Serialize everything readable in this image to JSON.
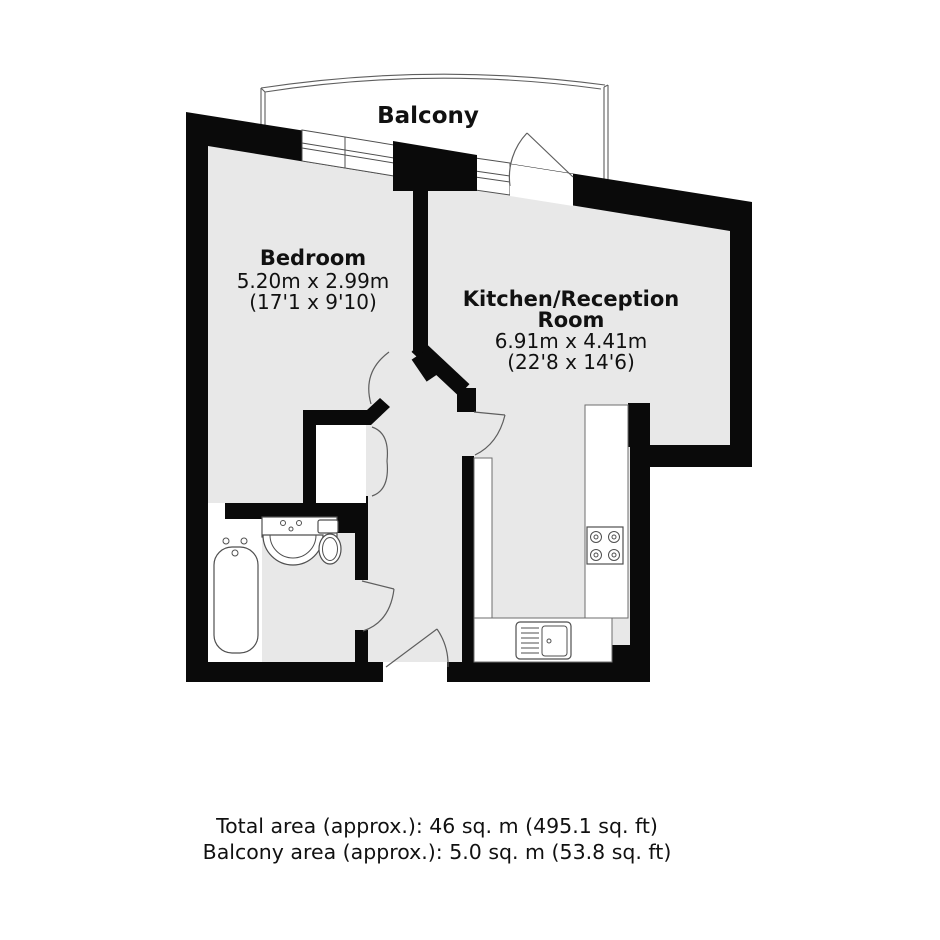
{
  "title": "Floor plan",
  "colors": {
    "floor": "#e8e8e8",
    "wall": "#0a0a0a",
    "line": "#4f4f4f",
    "text": "#111111",
    "background": "#ffffff"
  },
  "balcony": {
    "label": "Balcony"
  },
  "bedroom": {
    "label": "Bedroom",
    "size_metric": "5.20m x 2.99m",
    "size_imperial": "(17'1 x 9'10)"
  },
  "kitchen_reception": {
    "label_line1": "Kitchen/Reception",
    "label_line2": "Room",
    "size_metric": "6.91m x 4.41m",
    "size_imperial": "(22'8 x 14'6)"
  },
  "fixtures": {
    "bathtub": "bathtub",
    "basin": "wash-basin",
    "toilet": "toilet",
    "hob": "4-ring hob",
    "sink": "kitchen sink",
    "worktop": "worktop"
  },
  "footer": {
    "line1": "Total area (approx.): 46 sq. m (495.1 sq. ft)",
    "line2": "Balcony area (approx.): 5.0 sq. m (53.8 sq. ft)"
  }
}
